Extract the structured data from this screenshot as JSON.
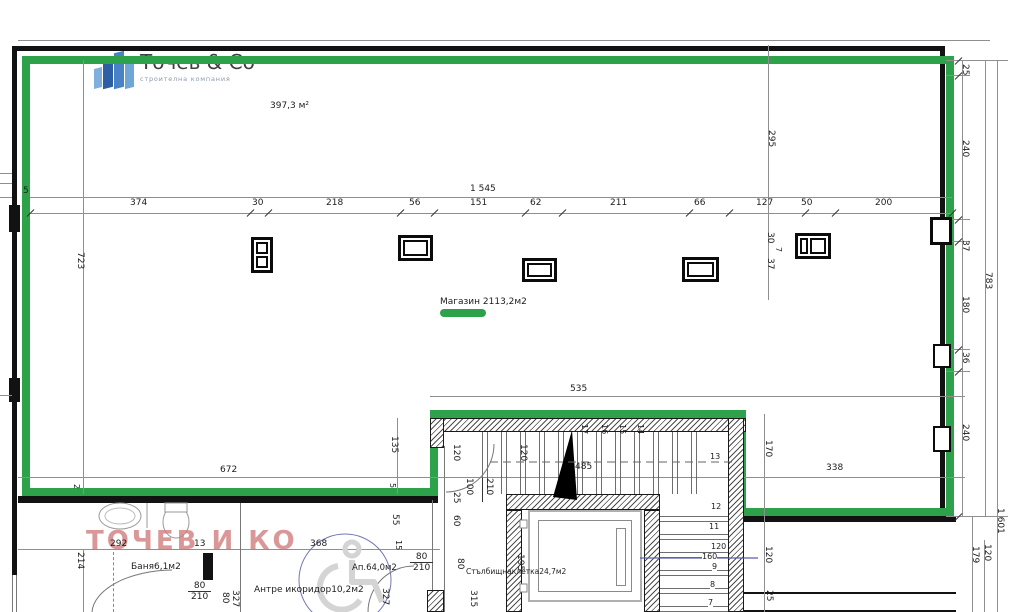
{
  "logo": {
    "name": "Точев & Co",
    "tagline": "строителна компания"
  },
  "labels": {
    "total_area": "397,3 м²",
    "shop": "Магазин 2113,2м2",
    "watermark": "ТОЧЕВ И КО",
    "bath": "Баня6,1м2",
    "hall": "Антре икоридор10,2м2",
    "apt": "Ап.64,0м2",
    "stairwell": "Стълбищнаклетка24,7м2"
  },
  "dims_top": {
    "total": "1 545",
    "chain": [
      "374",
      "30",
      "218",
      "56",
      "151",
      "62",
      "211",
      "66",
      "127",
      "50",
      "200"
    ]
  },
  "dims_mid": {
    "a": "295",
    "b": "30",
    "c": "7",
    "d": "37"
  },
  "dims_right": {
    "chain": [
      "25",
      "240",
      "37",
      "180",
      "36",
      "240"
    ],
    "span": "783",
    "total": "1 601",
    "low_a": "179",
    "low_b": "120"
  },
  "dims_left": {
    "height": "723",
    "a": "5",
    "b": "2",
    "c": "214"
  },
  "dims_bottom": {
    "a292": "292",
    "a13": "13",
    "a368": "368",
    "a672": "672",
    "a535": "535",
    "a485": "485",
    "a338": "338",
    "v135": "135",
    "v5": "5",
    "v55": "55",
    "v15": "15",
    "v327a": "327",
    "v80a": "80",
    "v327b": "327",
    "v315": "315",
    "v80b": "80",
    "v60": "60",
    "v25a": "25",
    "v25b": "25",
    "v120a": "120",
    "v120b": "120",
    "v170": "170",
    "v120c": "120",
    "v25c": "25",
    "v195": "195"
  },
  "doors": {
    "d1w": "80",
    "d1h": "210",
    "d2w": "80",
    "d2h": "210",
    "d3w": "100",
    "d3h": "210"
  },
  "stair": {
    "top_steps": [
      "17",
      "16",
      "15",
      "14"
    ],
    "right_steps": [
      "13",
      "12",
      "11",
      "9",
      "8",
      "7"
    ],
    "r120": "120",
    "r160": "160"
  }
}
